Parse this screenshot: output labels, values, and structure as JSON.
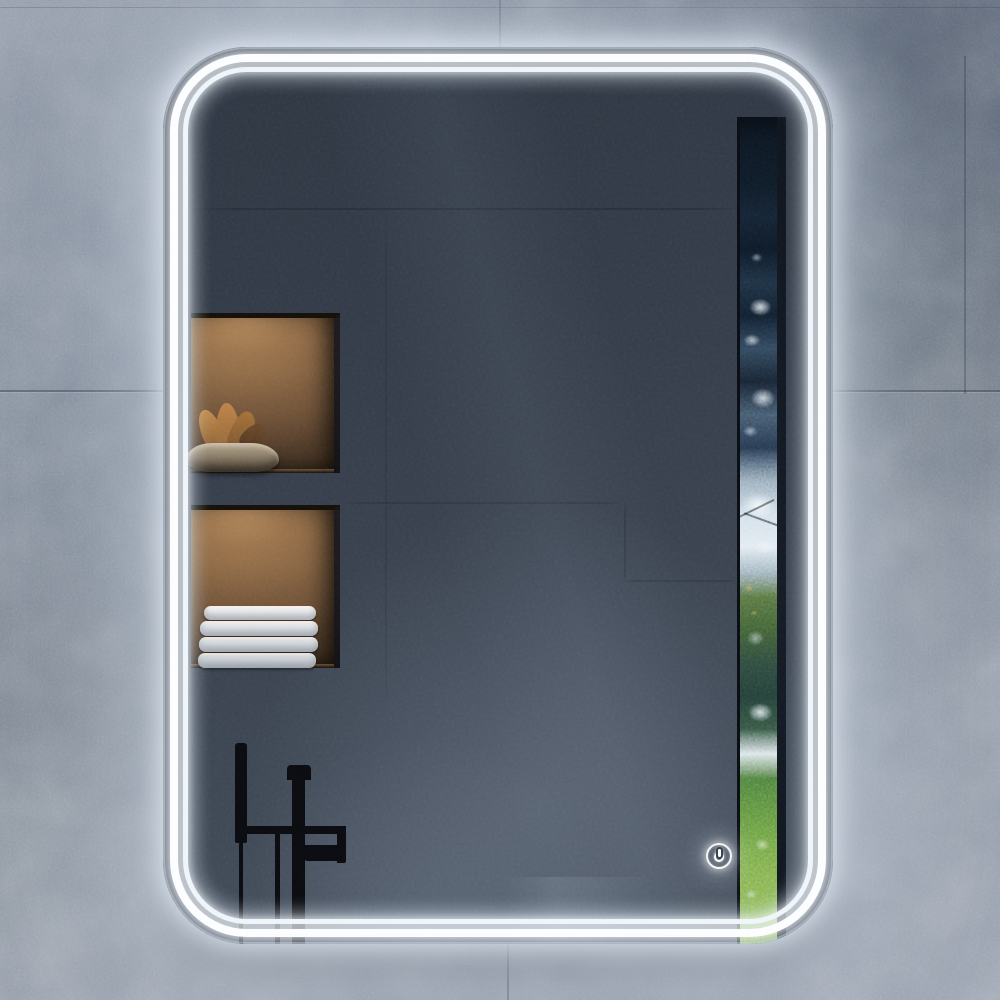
{
  "scene": {
    "type": "product-photo",
    "description": "Backlit LED bathroom vanity mirror with rounded corners and a double light band, mounted on a gray concrete-tile wall",
    "width_px": 1000,
    "height_px": 1000
  },
  "labels": {
    "wall": "gray concrete tile wall",
    "mirror": "LED bathroom mirror with rounded corners",
    "led_halo": "soft LED glow band",
    "led_outer": "outer LED light line",
    "led_inner": "inner LED light line",
    "upper_niche": "reflected backlit shelf niche with stone bowl and dried plant",
    "lower_niche": "reflected backlit shelf niche with folded towels",
    "bowl": "textured stone bowl",
    "plant": "dried leaves in bowl",
    "towel_stack": "stack of folded white towels",
    "faucet": "black freestanding faucet silhouette reflection",
    "window_strip": "reflected window view with sky and green trees",
    "power_button": "touch power button with power symbol"
  },
  "colors": {
    "wall-a": "#8f98a7",
    "wall-b": "#79838f",
    "wall-c": "#9aa2b0",
    "glass-a": "#2e3642",
    "glass-b": "#46505d",
    "led": "#ffffff",
    "led-soft": "#eef5fb",
    "niche-mid": "#7d5d40",
    "towel": "#f3f3f2",
    "faucet": "#0a0c10",
    "grn-a": "#7fae4e",
    "grn-b": "#3e5c33",
    "navy": "#0c1520",
    "sky": "#dfe9f0"
  },
  "power_button": {
    "symbol": "power",
    "state": "illuminated"
  },
  "reflection": {
    "towel_count": 4,
    "upper_niche_items": [
      "stone bowl",
      "dried plant"
    ],
    "lower_niche_items": [
      "folded towels"
    ],
    "right_strip": "window view with trees",
    "fixture": "black freestanding tub faucet with hand shower"
  }
}
